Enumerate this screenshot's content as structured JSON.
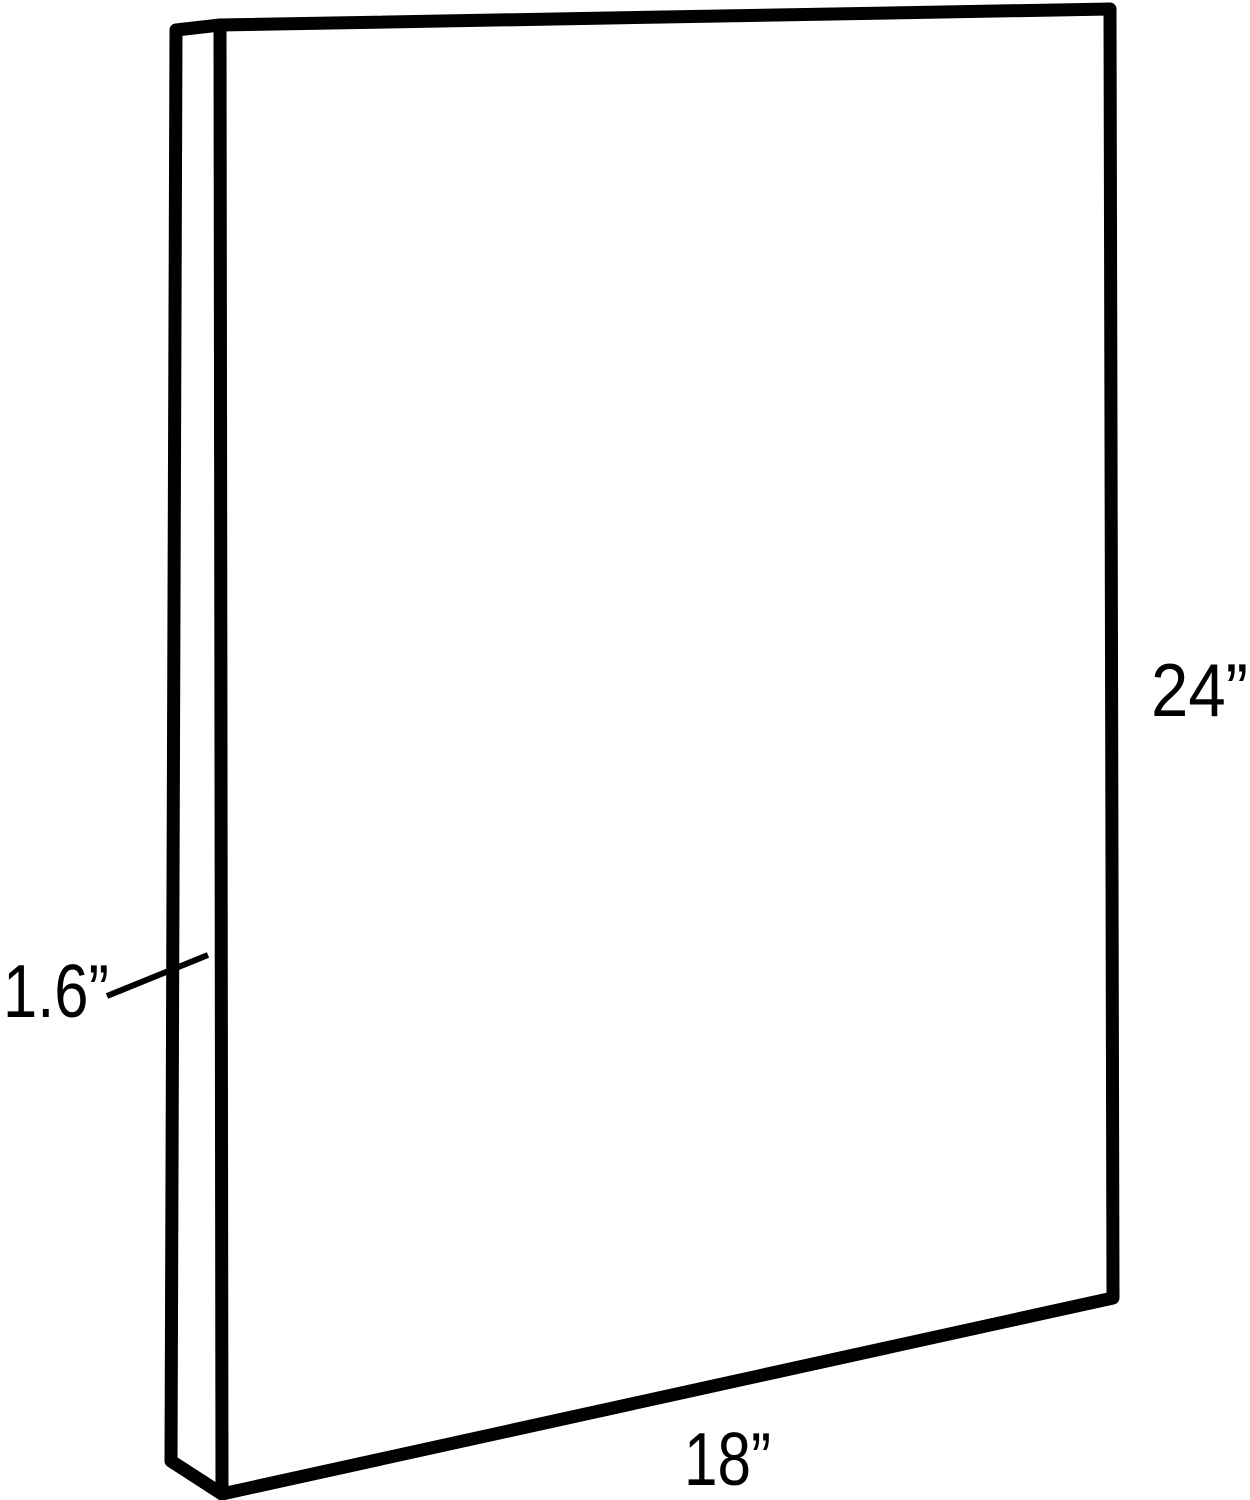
{
  "diagram": {
    "labels": {
      "height": "24”",
      "width": "18”",
      "depth": "1.6”"
    },
    "dimensions": {
      "height_inches": 24,
      "width_inches": 18,
      "depth_inches": 1.6,
      "unit": "inches"
    },
    "colors": {
      "line": "#000000",
      "text": "#000000",
      "background": "#ffffff"
    }
  }
}
